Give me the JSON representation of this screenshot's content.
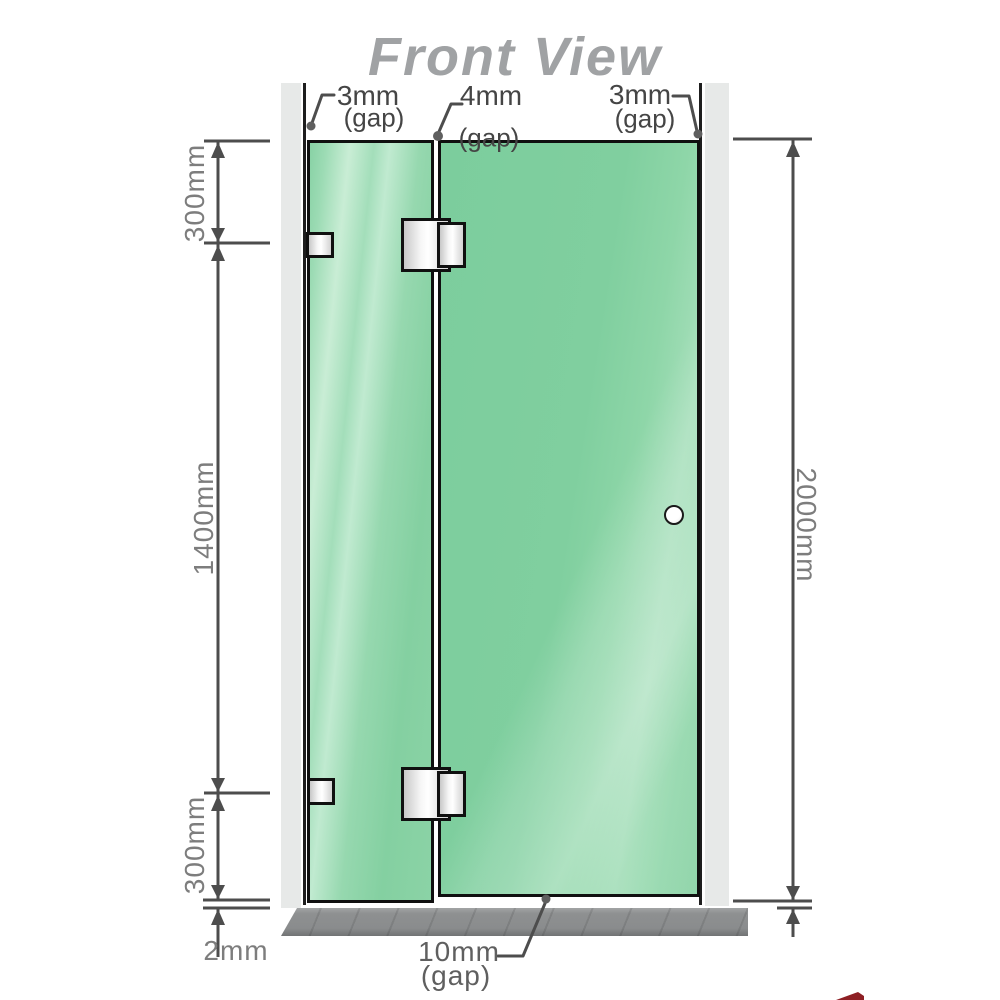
{
  "title": "Front View",
  "top_labels": [
    {
      "value": "3mm",
      "suffix": "(gap)"
    },
    {
      "value": "4mm",
      "suffix": "(gap)"
    },
    {
      "value": "3mm",
      "suffix": "(gap)"
    }
  ],
  "dimensions": {
    "left_top": "300mm",
    "left_middle": "1400mm",
    "left_bottom": "300mm",
    "floor_gap": "2mm",
    "right_height": "2000mm",
    "bottom_gap": {
      "value": "10mm",
      "suffix": "(gap)"
    }
  },
  "colors": {
    "glass_green": "#84d0a4",
    "glass_highlight": "#c9edd5",
    "wall_channel_gray": "#e7e9e8",
    "floor_gray": "#8e9091",
    "outline_black": "#101010",
    "dimension_line_gray": "#4d4d4d",
    "dimension_text_gray": "#7d7d7d",
    "label_text_gray": "#454545",
    "title_gray": "#a0a2a4",
    "brand_red": "#8e1f24"
  }
}
